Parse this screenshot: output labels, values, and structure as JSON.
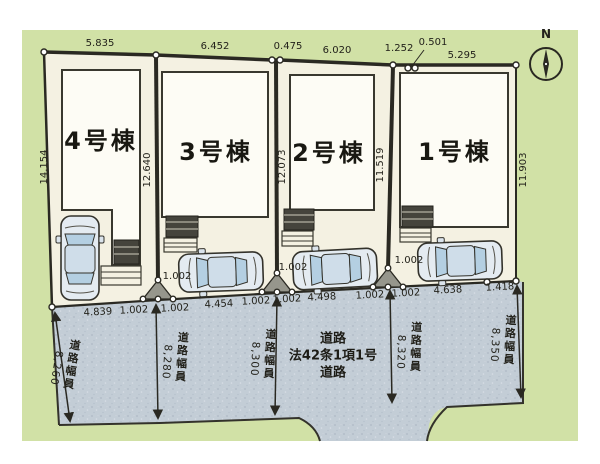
{
  "compass": {
    "label": "N"
  },
  "buildings": [
    "4号棟",
    "3号棟",
    "2号棟",
    "1号棟"
  ],
  "dims": {
    "top": [
      "5.835",
      "6.452",
      "0.475",
      "6.020",
      "1.252",
      "0.501",
      "5.295"
    ],
    "left": "14.154",
    "sides": [
      "12.640",
      "12.073",
      "11.519",
      "11.903"
    ],
    "frontage": [
      "4.839",
      "1.002",
      "1.002",
      "4.454",
      "1.002",
      "1.002",
      "4.498",
      "1.002",
      "1.002",
      "4.638",
      "1.418"
    ],
    "setbacks": [
      "1.002",
      "1.002",
      "1.002"
    ]
  },
  "road": {
    "width_label": "道路幅員",
    "widths": [
      "8,260",
      "8,280",
      "8,300",
      "8,320",
      "8,350"
    ],
    "designation": [
      "道路",
      "法42条1項1号",
      "道路"
    ]
  },
  "colors": {
    "grass": "#d1e1a6",
    "road": "#c3cdd6",
    "lot": "#f4f1e2",
    "building": "#fdfcf5",
    "line": "#2a2922",
    "car_glass": "#b4cfe2"
  }
}
